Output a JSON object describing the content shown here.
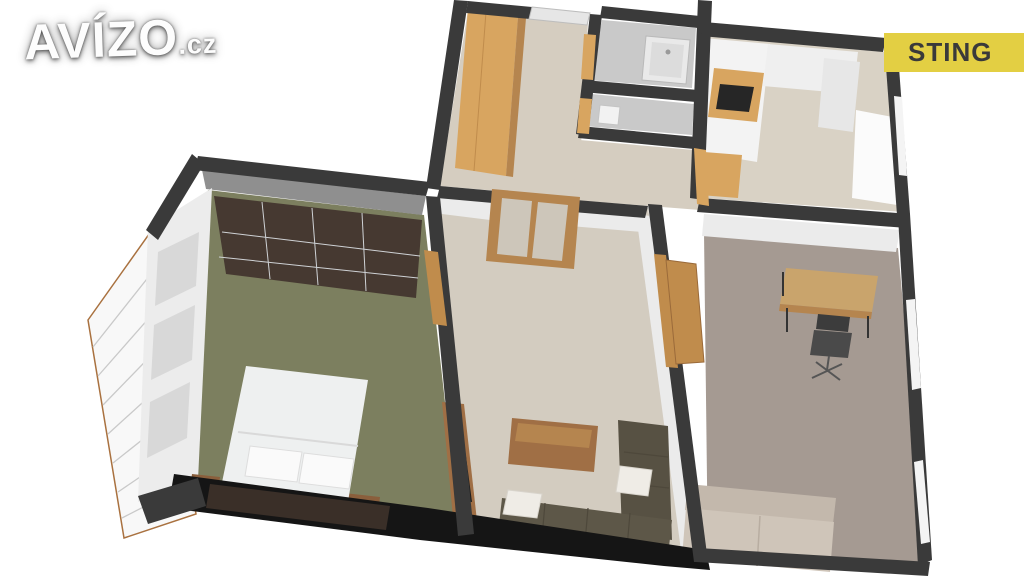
{
  "branding": {
    "logo": {
      "text": "AVÍZO",
      "suffix": ".cz",
      "color": "#fdfdfd"
    },
    "badge": {
      "label": "STING",
      "background": "#e3cf43",
      "text_color": "#3a3a3a"
    }
  },
  "floorplan": {
    "kind": "3d-apartment-floorplan-render",
    "colors": {
      "wall_dark": "#3a3a3a",
      "wall_face_gray": "#8f8f8f",
      "wall_face_light": "#ebebeb",
      "bath_gray": "#c9c9c9",
      "wood_light": "#d8a560",
      "wood_mid": "#b5854f",
      "wood_dark": "#8a5f3c",
      "wood_table": "#a06f45",
      "floor_bedroom": "#7c7f5f",
      "floor_living": "#d3ccc0",
      "floor_hall": "#d5cdc0",
      "floor_kitchen": "#d9d2c5",
      "floor_study": "#a59a92",
      "wardrobe_dark": "#463931",
      "sofa_dark": "#5d5748",
      "sofa_light": "#cfc5b9",
      "bed_white": "#eef0f0",
      "shadow": "#151515",
      "glass": "#d8d8d8",
      "white_unit": "#f3f3f3"
    },
    "objects": [
      "balcony-with-railing",
      "bedroom-sliding-wardrobe",
      "double-bed",
      "nightstands",
      "tv-cabinet",
      "interior-double-glass-door",
      "coffee-table",
      "corner-sofa",
      "hall-wardrobe",
      "entry-door",
      "bathtub",
      "kitchen-cabinets",
      "cooktop",
      "kitchen-window",
      "desk",
      "office-chair",
      "study-sofa",
      "study-windows"
    ]
  }
}
